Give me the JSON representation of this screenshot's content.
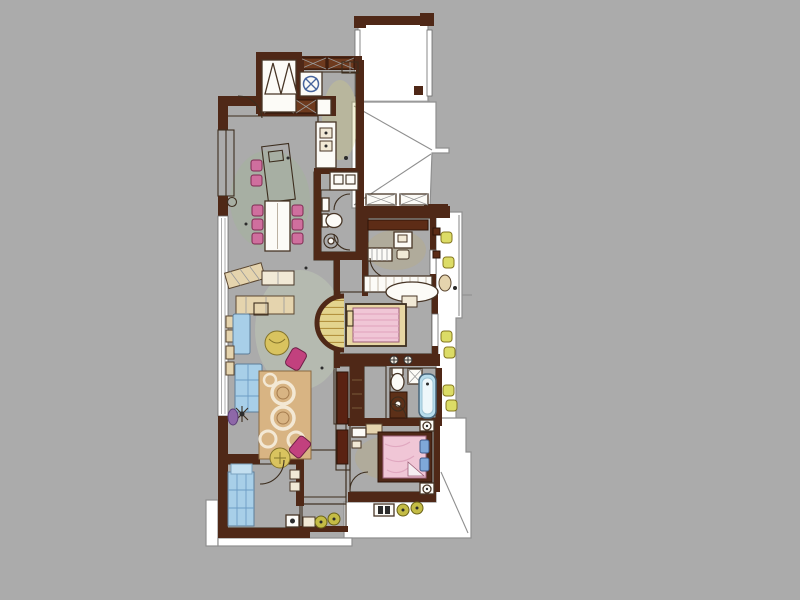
{
  "scene": "hand-drawn-watercolor-apartment-floor-plan",
  "canvas": {
    "background": "#ababab",
    "paper": "#ffffff"
  },
  "palette": {
    "wall": "#4f2817",
    "cabinet_brown": "#5d2c16",
    "floor_green": "#bdd7ac",
    "floor_green_line": "#8fb07e",
    "floor_yellow": "#eae7a4",
    "floor_yellow_line": "#c6bf78",
    "floor_wood": "#e3d48e",
    "floor_wood_stripe": "#b3923f",
    "floor_tan": "#e6d7a8",
    "floor_tan_line": "#bda877",
    "floor_white": "#f5f5f2",
    "floor_white_line": "#cdcdc9",
    "rug_tan": "#d8b483",
    "sofa_blue": "#a8cfe8",
    "accent_pink": "#cf6f9e",
    "accent_magenta": "#c2417e",
    "bed_pink": "#f0c6d6",
    "ottoman_gold": "#d9c35f",
    "stool_yellow": "#dcdc66",
    "stool_olive": "#c4bc45",
    "sink_blue": "#7fb3d9",
    "tub_blue": "#b7dcec",
    "fixture_white": "#fcfbf7",
    "terrace_line": "#8f8f8f",
    "ink": "#3c2d1e"
  },
  "rooms": [
    {
      "id": "entry-foyer",
      "floor": "white"
    },
    {
      "id": "kitchen",
      "floor": "yellow-tile"
    },
    {
      "id": "living-dining",
      "floor": "green-tile"
    },
    {
      "id": "powder-room",
      "floor": "green-tile"
    },
    {
      "id": "study-bedroom",
      "floor": "wood-plank"
    },
    {
      "id": "master-bedroom",
      "floor": "wood-plank"
    },
    {
      "id": "bathroom",
      "floor": "white-tile"
    },
    {
      "id": "rear-bedroom",
      "floor": "wood-plank"
    },
    {
      "id": "family-room",
      "floor": "tan-tile"
    },
    {
      "id": "green-balcony",
      "floor": "green-tile"
    },
    {
      "id": "top-terrace",
      "floor": "white"
    },
    {
      "id": "right-terrace",
      "floor": "white"
    },
    {
      "id": "bottom-terrace",
      "floor": "white"
    }
  ],
  "furniture": [
    "coat-closet",
    "range-cooktop",
    "kitchen-sink",
    "kitchen-island",
    "double-vanity",
    "dining-console",
    "dining-table",
    "dining-chair",
    "tv-console",
    "sideboard",
    "sectional-sofa",
    "round-ottoman",
    "accent-chair",
    "area-rug",
    "floor-lamp",
    "toilet",
    "wash-basin",
    "bathtub",
    "shower-box",
    "desk",
    "desk-chair",
    "oval-table",
    "dresser",
    "double-bed",
    "single-bed",
    "wardrobe",
    "night-stand",
    "table-lamp",
    "balcony-stool",
    "side-table",
    "day-bed",
    "ac-unit",
    "slippers"
  ]
}
